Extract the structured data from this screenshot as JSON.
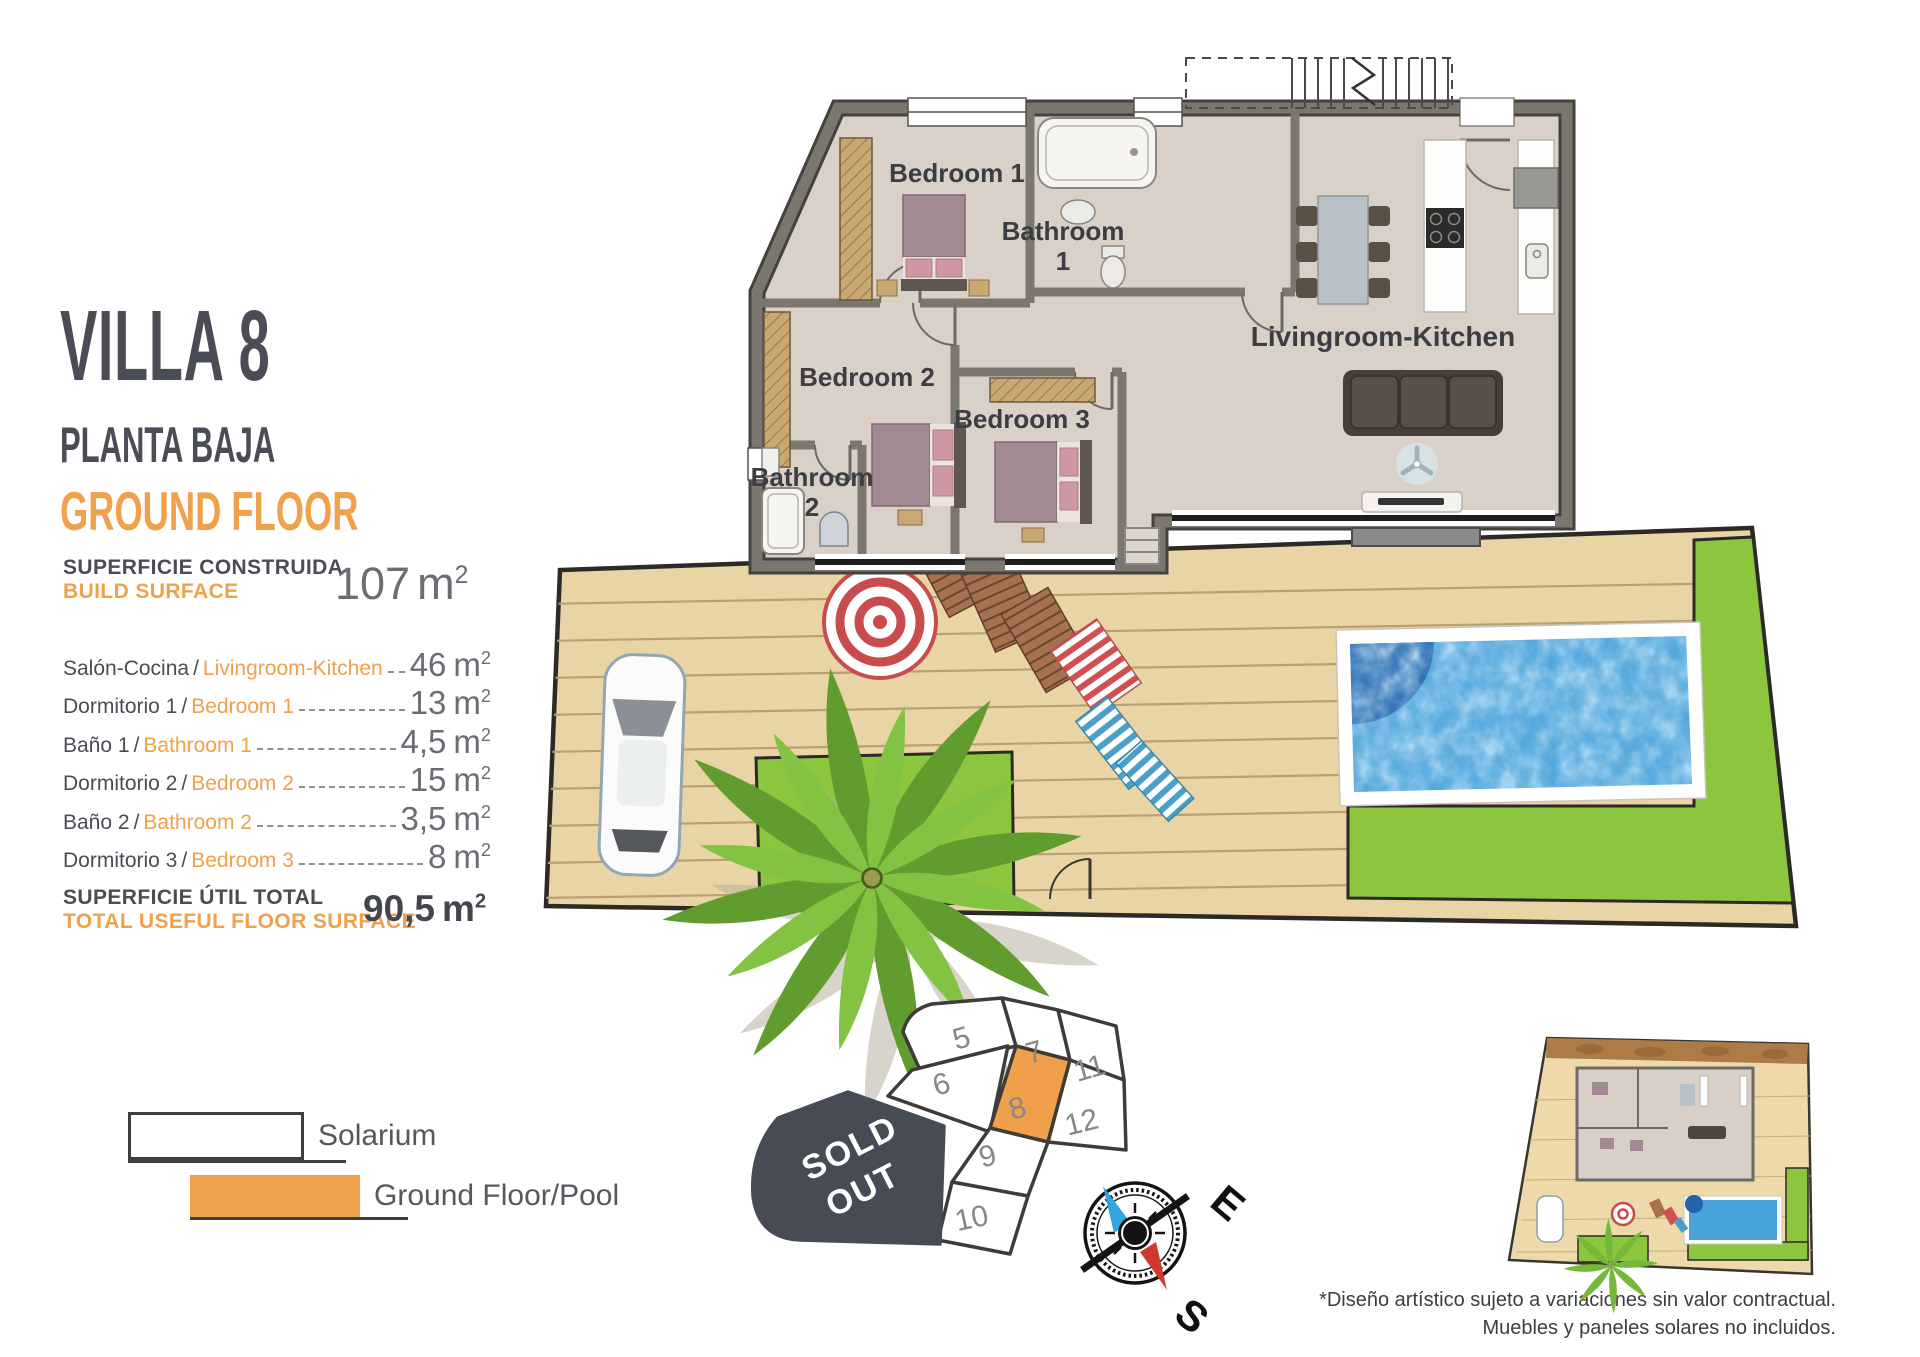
{
  "header": {
    "title": "VILLA 8",
    "subtitle_es": "PLANTA BAJA",
    "subtitle_en": "GROUND FLOOR"
  },
  "build_surface": {
    "label_es": "SUPERFICIE CONSTRUIDA",
    "label_en": "BUILD SURFACE",
    "value": "107"
  },
  "rooms": [
    {
      "es": "Salón-Cocina",
      "en": "Livingroom-Kitchen",
      "size": "46"
    },
    {
      "es": "Dormitorio 1",
      "en": "Bedroom 1",
      "size": "13"
    },
    {
      "es": "Baño 1",
      "en": "Bathroom 1",
      "size": "4,5"
    },
    {
      "es": "Dormitorio 2",
      "en": "Bedroom 2",
      "size": "15"
    },
    {
      "es": "Baño 2",
      "en": "Bathroom 2",
      "size": "3,5"
    },
    {
      "es": "Dormitorio 3",
      "en": "Bedroom 3",
      "size": "8"
    }
  ],
  "total": {
    "label_es": "SUPERFICIE ÚTIL TOTAL",
    "label_en": "TOTAL USEFUL FLOOR SURFACE",
    "value": "90,5"
  },
  "units": {
    "m": "m",
    "sup": "2",
    "separator": "/"
  },
  "legend": [
    {
      "label": "Solarium",
      "color": "#ffffff"
    },
    {
      "label": "Ground Floor/Pool",
      "color": "#f0a14b"
    }
  ],
  "plan": {
    "rooms": {
      "bedroom1": "Bedroom 1",
      "bathroom1_line1": "Bathroom",
      "bathroom1_line2": "1",
      "bedroom2": "Bedroom 2",
      "bedroom3": "Bedroom 3",
      "bathroom2_line1": "Bathroom",
      "bathroom2_line2": "2",
      "living": "Livingroom-Kitchen"
    }
  },
  "lot_map": {
    "plots": [
      "5",
      "6",
      "7",
      "8",
      "9",
      "10",
      "11",
      "12"
    ],
    "highlighted_plot": "8",
    "sold_out_line1": "SOLD",
    "sold_out_line2": "OUT"
  },
  "compass": {
    "east": "E",
    "south": "S"
  },
  "disclaimer": {
    "line1": "*Diseño artístico sujeto a variaciones sin valor contractual.",
    "line2": "Muebles y paneles solares no incluidos."
  },
  "colors": {
    "accent_orange": "#F0A14B",
    "dark_slate": "#4A4D55",
    "grass": "#8CC63E",
    "pool_water": "#4AA2DA",
    "deck": "#E9D4A5",
    "sold_out": "#474B55",
    "wall": "#7B776F"
  }
}
